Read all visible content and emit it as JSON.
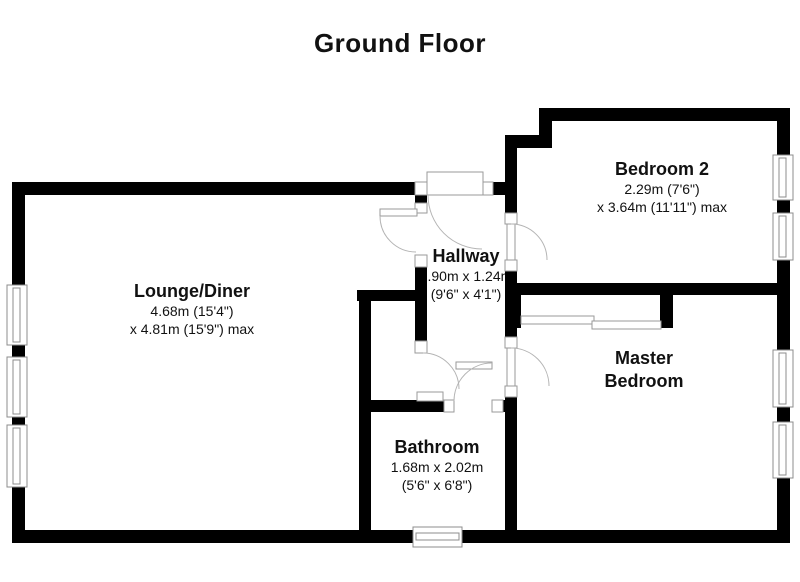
{
  "title": "Ground Floor",
  "rooms": [
    {
      "name": "Lounge/Diner",
      "dim1": "4.68m (15'4\")",
      "dim2": "x 4.81m (15'9\") max"
    },
    {
      "name": "Hallway",
      "dim1": "2.90m x 1.24m",
      "dim2": "(9'6\" x 4'1\")"
    },
    {
      "name": "Bathroom",
      "dim1": "1.68m x 2.02m",
      "dim2": "(5'6\" x 6'8\")"
    },
    {
      "name": "Bedroom 2",
      "dim1": "2.29m (7'6\")",
      "dim2": "x 3.64m (11'11\") max"
    },
    {
      "name": "Master Bedroom",
      "dim1": "",
      "dim2": ""
    }
  ],
  "features": {
    "doors": [
      "entry-door",
      "lounge-door",
      "cupboard-door",
      "bathroom-door",
      "master-bedroom-door",
      "bedroom2-door"
    ],
    "windows_count": 8,
    "wardrobe": "sliding-door-wardrobe"
  },
  "colors": {
    "wall": "#000000",
    "background": "#ffffff",
    "outline_gray": "#9a9a9a",
    "text": "#111111"
  }
}
